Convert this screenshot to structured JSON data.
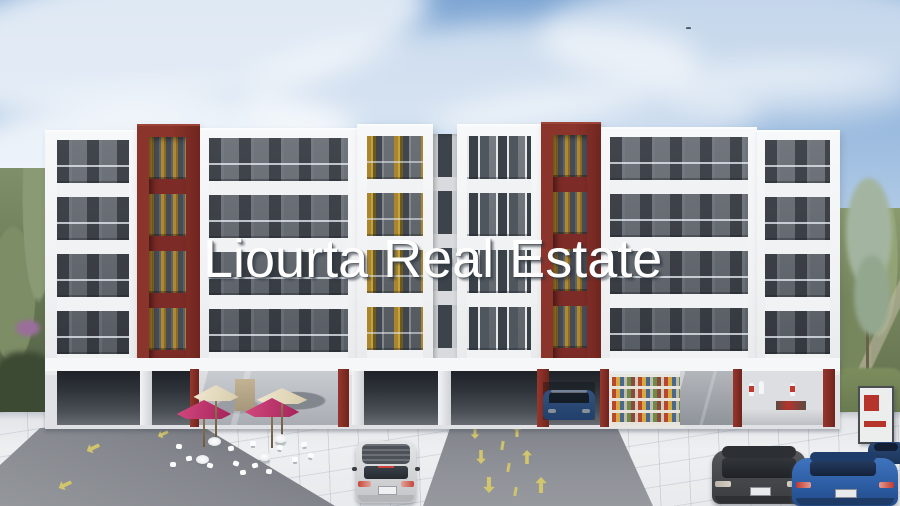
{
  "watermark": {
    "text": "Liourta Real Estate",
    "color": "#ffffff"
  },
  "scene": {
    "type": "architectural-rendering-of-apartment-building",
    "building": {
      "floors_visible": 4,
      "red_accent_towers": 2,
      "facade_color": "#f3f4f6",
      "accent_color": "#7c2b26",
      "balcony_wall_color": "#5e646b",
      "curtain_color": "#b8922f"
    },
    "ground_floor_units": [
      "garage-ramp-left",
      "cafe-with-terrace",
      "central-garage-driveway",
      "bookshop",
      "boutique-with-mannequins"
    ],
    "cafe_terrace": {
      "umbrella_colors": [
        "#eee3c9",
        "#c23570",
        "#eee3c9",
        "#c23570"
      ],
      "furniture_color": "#ffffff"
    },
    "vehicles": [
      {
        "name": "silver-hatchback",
        "color": "#d9dbdc"
      },
      {
        "name": "blue-car-in-garage",
        "color": "#3f6cb2"
      },
      {
        "name": "gray-hatchback",
        "color": "#46484b"
      },
      {
        "name": "blue-sedan",
        "color": "#2d5da5"
      },
      {
        "name": "navy-car-partial",
        "color": "#20375c"
      }
    ],
    "road_markings": {
      "color": "#d9cb68",
      "arrows": "two-way lane arrows and dashed divider"
    },
    "signage_totem": {
      "panel_color": "#eceded",
      "accent_color": "#b5342c"
    },
    "sky": {
      "top": "#7ea6d3",
      "horizon": "#ebf1f7",
      "clouds": "wispy white"
    },
    "vegetation": {
      "left_hill": "#6d7d58",
      "right_hill": "#72815a",
      "tall_tree": "#a9bba6"
    },
    "plaza": {
      "tile_color": "#edeff1",
      "asphalt_color": "#83868c"
    }
  }
}
